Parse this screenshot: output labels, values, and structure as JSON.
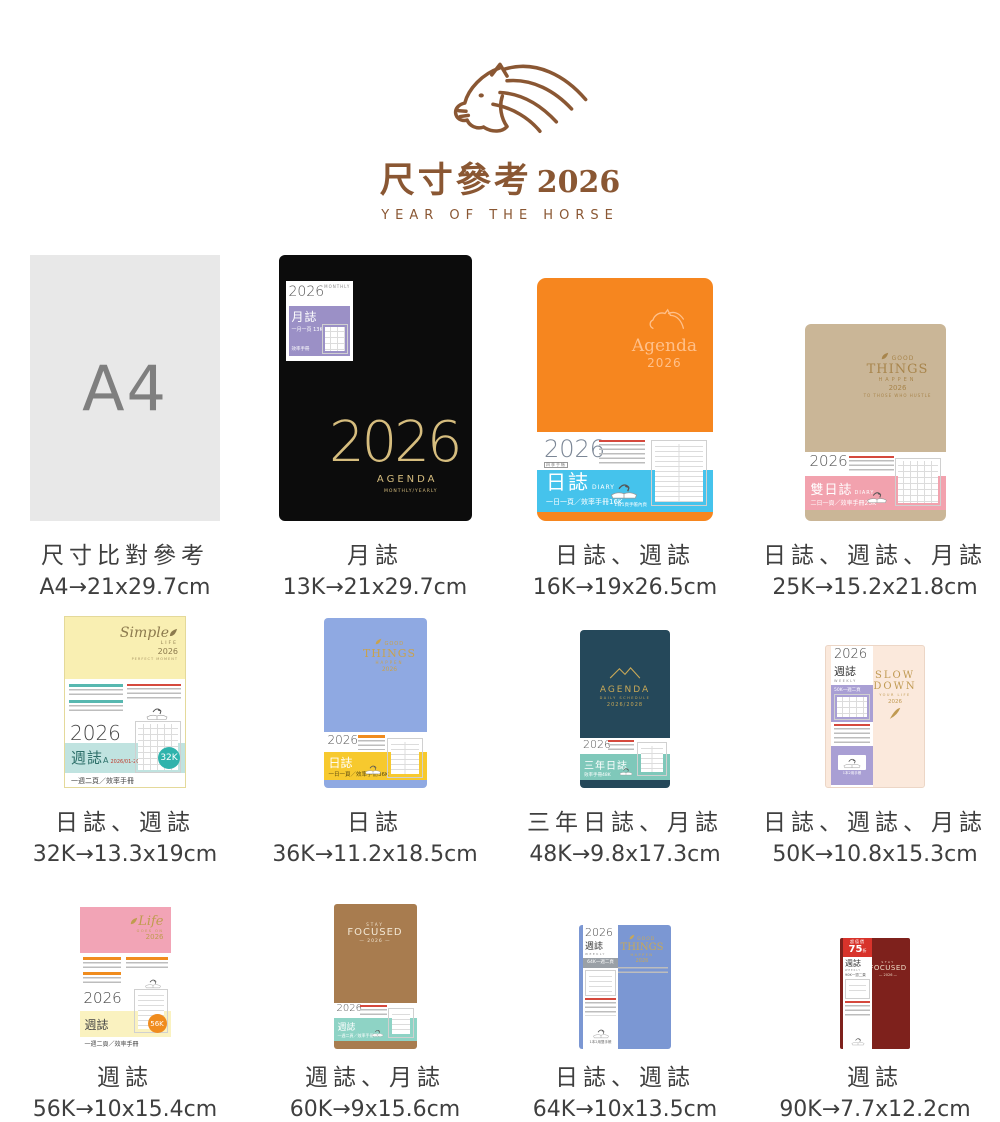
{
  "header": {
    "title": "尺寸參考",
    "year": "2026",
    "subtitle": "YEAR OF THE HORSE",
    "brand_color": "#8a5733"
  },
  "products": [
    {
      "name": "A4 尺寸比對",
      "caption": "尺寸比對參考",
      "size": "A4→21x29.7cm",
      "cover": {
        "label": "A4"
      },
      "colors": {
        "cover": "#e8e8e8",
        "label": "#7f7f7f"
      }
    },
    {
      "name": "13K 月誌",
      "caption": "月誌",
      "size": "13K→21x29.7cm",
      "cover": {
        "year_digits": "2026",
        "brand": "AGENDA",
        "brand_sub": "MONTHLY/YEARLY",
        "sticker_year": "2026",
        "sticker_tag": "MONTHLY",
        "sticker_title": "月誌",
        "sticker_spec": "一月一頁 13K",
        "sticker_note": "效率手冊"
      },
      "colors": {
        "cover": "#0c0c0c",
        "gold": "#d6bd7e",
        "sticker_band": "#9b90c6"
      }
    },
    {
      "name": "16K 日誌",
      "caption": "日誌、週誌",
      "size": "16K→19x26.5cm",
      "cover": {
        "emboss_brand": "Agenda",
        "emboss_year": "2026",
        "band_year": "2026",
        "band_year_sub": "四季手帳",
        "band_title": "日誌",
        "band_title_en": "DIARY",
        "band_spec": "一日一頁／效率手冊16K",
        "thumb_note": "1日1頁手帳內頁"
      },
      "colors": {
        "cover": "#f6861f",
        "emboss": "#ffc08a",
        "band": "#45c3ec"
      }
    },
    {
      "name": "25K 雙日誌",
      "caption": "日誌、週誌、月誌",
      "size": "25K→15.2x21.8cm",
      "cover": {
        "brand1": "GOOD",
        "brand2": "THINGS",
        "brand3": "HAPPEN",
        "brand4": "2026",
        "brand5": "TO THOSE WHO HUSTLE",
        "band_year": "2026",
        "band_title": "雙日誌",
        "band_title_en": "DIARY",
        "band_spec": "二日一頁／效率手冊25K"
      },
      "colors": {
        "cover": "#cab697",
        "gold": "#a8854c",
        "band": "#f2a2ae"
      }
    },
    {
      "name": "32K 週誌",
      "caption": "日誌、週誌",
      "size": "32K→13.3x19cm",
      "cover": {
        "brand1": "Simple",
        "brand2": "LIFE",
        "brand3": "2026",
        "band_year": "2026",
        "band_title": "週誌",
        "band_title_suffix": "A",
        "band_range": "2026/01-2026/12",
        "badge": "32K",
        "band_spec": "一週二頁／效率手冊"
      },
      "colors": {
        "cover": "#f9efb2",
        "brand": "#8c7a4e",
        "band": "#c0e3e0",
        "badge": "#2fb3ac"
      }
    },
    {
      "name": "36K 日誌",
      "caption": "日誌",
      "size": "36K→11.2x18.5cm",
      "cover": {
        "brand1": "GOOD",
        "brand2": "THINGS",
        "brand3": "HAPPEN",
        "brand4": "2026",
        "band_year": "2026",
        "band_title": "日誌",
        "band_spec": "一日一頁／效率手冊36K"
      },
      "colors": {
        "cover": "#8fa9e2",
        "gold": "#c8a24e",
        "band": "#f7c92e"
      }
    },
    {
      "name": "48K 三年日誌",
      "caption": "三年日誌、月誌",
      "size": "48K→9.8x17.3cm",
      "cover": {
        "brand1": "AGENDA",
        "brand2": "DAILY SCHEDULE",
        "brand3": "2026/2028",
        "band_year": "2026",
        "band_title": "三年日誌",
        "band_spec": "效率手冊48K"
      },
      "colors": {
        "cover": "#25485a",
        "gold": "#c8a857",
        "band": "#7fc8ba"
      }
    },
    {
      "name": "50K 週誌",
      "caption": "日誌、週誌、月誌",
      "size": "50K→10.8x15.3cm",
      "cover": {
        "brand1": "SLOW",
        "brand2": "DOWN",
        "brand3": "YOUR LIFE",
        "brand4": "2026",
        "band_year": "2026",
        "band_title": "週誌",
        "band_title_en": "WEEKLY",
        "band_spec": "50K一週二頁"
      },
      "colors": {
        "cover": "#fbe9dc",
        "gold": "#c09a52",
        "band": "#a99fd4"
      }
    },
    {
      "name": "56K 週誌",
      "caption": "週誌",
      "size": "56K→10x15.4cm",
      "cover": {
        "brand1": "Life",
        "brand2": "GOES ON",
        "brand3": "2026",
        "band_year": "2026",
        "band_title": "週誌",
        "badge": "56K",
        "band_spec": "一週二頁／效率手冊"
      },
      "colors": {
        "cover": "#f2a4b6",
        "gold": "#bf9c4e",
        "band": "#faf2c0",
        "badge": "#f08c1e"
      }
    },
    {
      "name": "60K 週誌",
      "caption": "週誌、月誌",
      "size": "60K→9x15.6cm",
      "cover": {
        "brand1": "STAY",
        "brand2": "FOCUSED",
        "brand3": "— 2026 —",
        "band_year": "2026",
        "band_title": "週誌",
        "band_spec": "一週二頁／效率手冊60K"
      },
      "colors": {
        "cover": "#a87c4f",
        "text": "#f2e7d4",
        "band": "#8ed3c5"
      }
    },
    {
      "name": "64K 週誌",
      "caption": "日誌、週誌",
      "size": "64K→10x13.5cm",
      "cover": {
        "brand1": "GOOD",
        "brand2": "THINGS",
        "brand3": "HAPPEN",
        "brand4": "2026",
        "band_year": "2026",
        "band_title": "週誌",
        "band_title_en": "WEEKLY",
        "band_spec": "64K一週二頁"
      },
      "colors": {
        "cover": "#7b97d3",
        "gold": "#c8a857",
        "band": "#9aa0a6"
      }
    },
    {
      "name": "90K 週誌",
      "caption": "週誌",
      "size": "90K→7.7x12.2cm",
      "cover": {
        "badge_label": "超值價",
        "badge_value": "75",
        "badge_suffix": "折",
        "brand1": "STAY",
        "brand2": "FOCUSED",
        "brand3": "— 2026 —",
        "band_title": "週誌",
        "band_title_en": "WEEKLY",
        "band_year": "2026",
        "band_spec": "90K一週二頁"
      },
      "colors": {
        "cover": "#7e211c",
        "text": "#ecd9c4",
        "badge": "#d8332b"
      }
    }
  ]
}
